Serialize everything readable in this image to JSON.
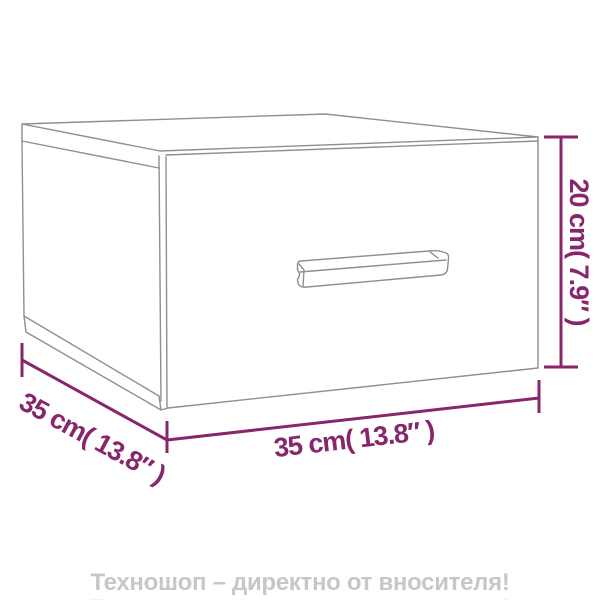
{
  "product": {
    "name": "wall-mounted nightstand with drawer (dimension diagram)"
  },
  "drawing": {
    "line_color": "#8f8f8f",
    "parts": [
      "top-face",
      "left-side-face",
      "front-drawer-face",
      "drawer-handle"
    ]
  },
  "dimensions": {
    "color": "#87266b",
    "height": {
      "cm": "20",
      "inches": "7.9",
      "label": "20 cm( 7.9″ )"
    },
    "width": {
      "cm": "35",
      "inches": "13.8",
      "label": "35 cm( 13.8″ )"
    },
    "depth": {
      "cm": "35",
      "inches": "13.8",
      "label": "35 cm( 13.8″ )"
    }
  },
  "watermark": {
    "text": "Техношоп – директно от вносителя!",
    "color": "#c7c7c7"
  }
}
